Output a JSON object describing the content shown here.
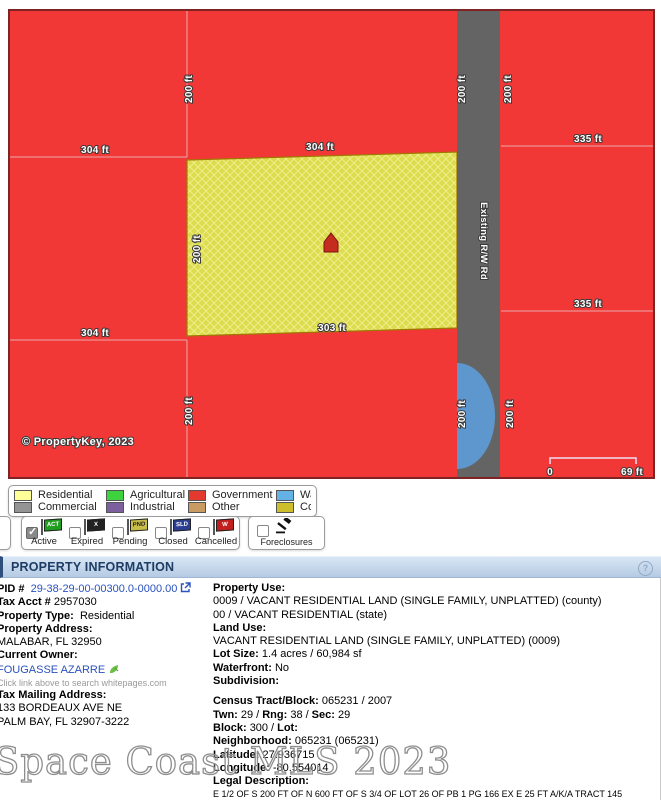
{
  "map": {
    "copyright": "© PropertyKey, 2023",
    "road_label": "Existing R/W Rd",
    "dims": {
      "w304": "304 ft",
      "w303": "303 ft",
      "h200": "200 ft",
      "w335": "335 ft"
    },
    "scale": {
      "start": "0",
      "end": "69 ft"
    },
    "colors": {
      "parcel_red": "#F23737",
      "parcel_yellow": "#DCDC4E",
      "hatch_line": "#F0F090",
      "road_gray": "#646464",
      "water_blue": "#5E97CE"
    }
  },
  "legend": {
    "items": [
      {
        "label": "Residential",
        "color": "#FFFF99"
      },
      {
        "label": "Agricultural",
        "color": "#3FD23F"
      },
      {
        "label": "Government",
        "color": "#E4392F"
      },
      {
        "label": "Water",
        "color": "#63B1E5"
      },
      {
        "label": "Commercial",
        "color": "#949494"
      },
      {
        "label": "Industrial",
        "color": "#7D5F9E"
      },
      {
        "label": "Other",
        "color": "#C89B63"
      },
      {
        "label": "Condo",
        "color": "#CCBF2B"
      }
    ]
  },
  "filters": {
    "check_glyph": "✓",
    "statuses": [
      {
        "label": "Active",
        "flag_text": "ACT",
        "flag_color": "#1F9E1F",
        "flag_text_color": "#FFFFFF",
        "checked": true
      },
      {
        "label": "Expired",
        "flag_text": "X",
        "flag_color": "#222222",
        "flag_text_color": "#FFFFFF",
        "checked": false
      },
      {
        "label": "Pending",
        "flag_text": "PND",
        "flag_color": "#C9BD4A",
        "flag_text_color": "#222222",
        "checked": false
      },
      {
        "label": "Closed",
        "flag_text": "SLD",
        "flag_color": "#2B3E91",
        "flag_text_color": "#FFFFFF",
        "checked": false
      },
      {
        "label": "Cancelled",
        "flag_text": "W",
        "flag_color": "#C2201D",
        "flag_text_color": "#FFFFFF",
        "checked": false
      }
    ],
    "foreclosures": {
      "label": "Foreclosures"
    }
  },
  "info": {
    "header": "PROPERTY INFORMATION",
    "help_glyph": "?",
    "left": {
      "pid_label": "PID #",
      "pid_value": "29-38-29-00-00300.0-0000.00",
      "tax_acct_label": "Tax Acct #",
      "tax_acct_value": "2957030",
      "property_type_label": "Property Type:",
      "property_type_value": "Residential",
      "property_address_label": "Property Address:",
      "property_address_value": "MALABAR, FL 32950",
      "current_owner_label": "Current Owner:",
      "current_owner_value": "FOUGASSE AZARRE",
      "whitepages_hint": "Click link above to search whitepages.com",
      "tax_mailing_label": "Tax Mailing Address:",
      "tax_mailing_line1": "133 BORDEAUX AVE NE",
      "tax_mailing_line2": "PALM BAY, FL 32907-3222"
    },
    "right": {
      "slash": "/",
      "property_use_label": "Property Use:",
      "property_use_county": "0009 / VACANT RESIDENTIAL LAND (SINGLE FAMILY, UNPLATTED) (county)",
      "property_use_state": "00 / VACANT RESIDENTIAL (state)",
      "land_use_label": "Land Use:",
      "land_use_value": "VACANT RESIDENTIAL LAND (SINGLE FAMILY, UNPLATTED) (0009)",
      "lot_size_label": "Lot Size:",
      "lot_size_value": "1.4 acres / 60,984 sf",
      "waterfront_label": "Waterfront:",
      "waterfront_value": "No",
      "subdivision_label": "Subdivision:",
      "census_label": "Census Tract/Block:",
      "census_value": "065231 / 2007",
      "twn_label": "Twn:",
      "twn_value": "29",
      "rng_label": "Rng:",
      "rng_value": "38",
      "sec_label": "Sec:",
      "sec_value": "29",
      "block_label": "Block:",
      "block_value": "300",
      "lot_label": "Lot:",
      "neighborhood_label": "Neighborhood:",
      "neighborhood_value": "065231 (065231)",
      "latitude_label": "Latitude:",
      "latitude_value": "27.936715",
      "longitude_label": "Longitude:",
      "longitude_value": "-80.554014",
      "legal_desc_label": "Legal Description:",
      "legal_desc_value": "E 1/2 OF S 200 FT OF N 600 FT OF S 3/4 OF LOT 26 OF PB 1 PG 166 EX E 25 FT A/K/A TRACT 145",
      "legal_book_label": "Legal Book:",
      "legal_book_value": "1 PG 166 EX E 25 FT A/K/A TRACT 145",
      "legal_page_label": "Legal Page:"
    }
  },
  "watermark": "Space Coast MLS 2023"
}
